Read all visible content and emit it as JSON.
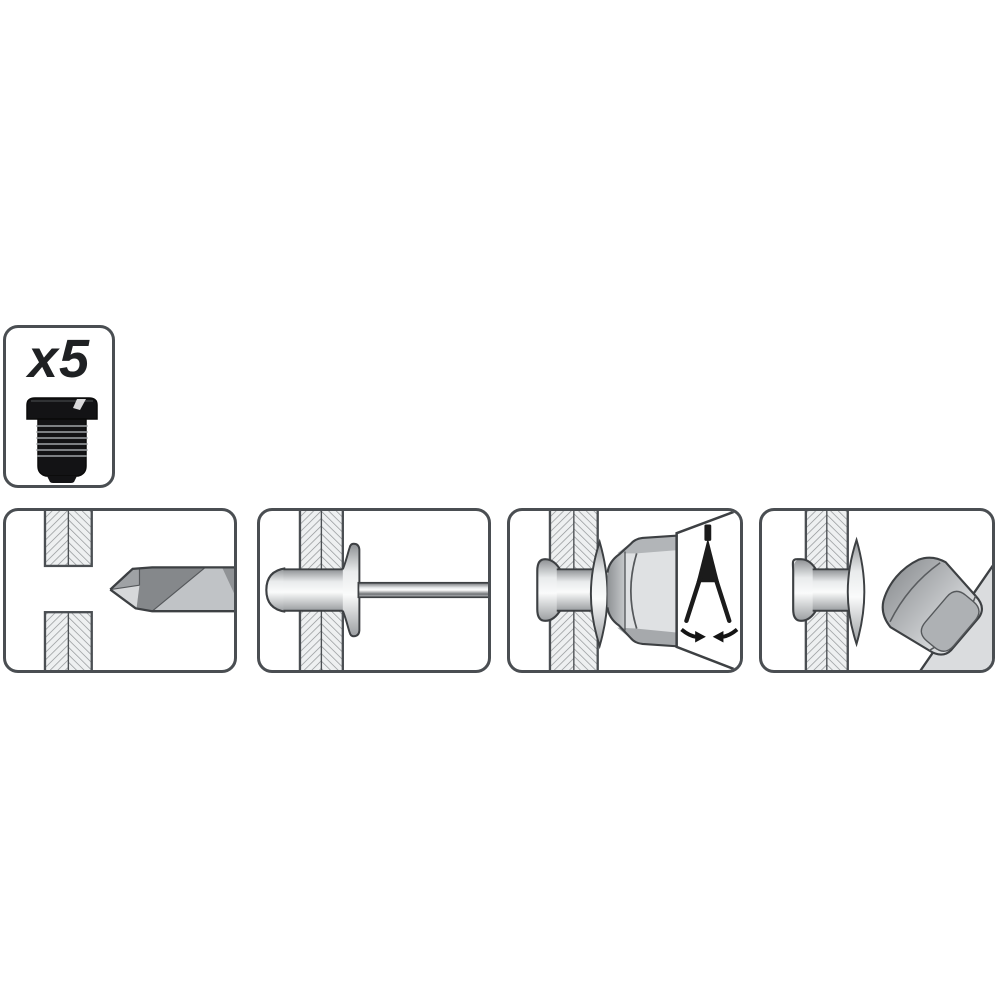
{
  "badge": {
    "label": "x5",
    "item_icon": "hex-head-rivet-nut-icon"
  },
  "steps": [
    {
      "index": 1,
      "icon": "drill-hole-icon",
      "description_icon_only": true
    },
    {
      "index": 2,
      "icon": "insert-blind-rivet-icon",
      "description_icon_only": true
    },
    {
      "index": 3,
      "icon": "compress-rivet-with-tool-icon",
      "description_icon_only": true
    },
    {
      "index": 4,
      "icon": "installed-rivet-cap-nut-icon",
      "description_icon_only": true
    }
  ],
  "colors": {
    "background": "#ffffff",
    "panel_border": "#4a4e52",
    "outline": "#3d4043",
    "hatch_fill": "#eef0f1",
    "hatch_line": "#8b8e91",
    "metal_light": "#e6e8ea",
    "metal_mid": "#b7babd",
    "metal_dark": "#85888b",
    "insert_black": "#131315",
    "symbol_black": "#1b1b1b"
  }
}
